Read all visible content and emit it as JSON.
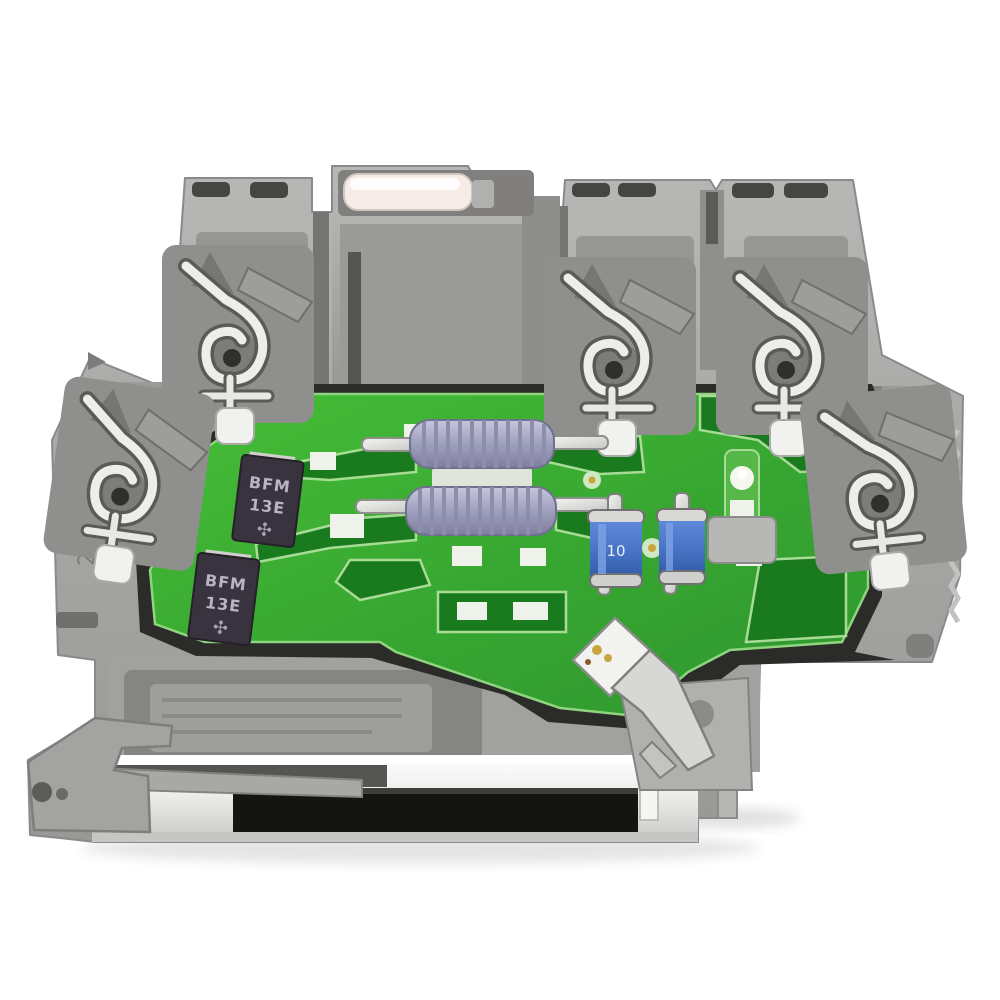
{
  "scene": {
    "type": "product-photograph",
    "subject": "Grey DIN-rail terminal block surge-protection module, cutaway housing showing green PCB with components, mounted on a DIN rail",
    "background_color": "#ffffff"
  },
  "labels": {
    "diode_top": {
      "line1": "BFM",
      "line2": "13E",
      "logo": "✣"
    },
    "diode_bottom": {
      "line1": "BFM",
      "line2": "13E",
      "logo": "✣"
    },
    "housing_marking": "2",
    "trimmer_left_marking": "10"
  },
  "palette": {
    "housing_grey": "#a6a6a4",
    "housing_grey_light": "#bcbcba",
    "housing_grey_dark": "#8b8b89",
    "housing_shadow": "#5f5f5d",
    "recess_dark": "#3c3c3a",
    "pcb_green_bright": "#43b835",
    "pcb_green": "#2f9630",
    "pcb_trace_dark": "#1a7a1e",
    "pcb_pale_outline": "#a8dc96",
    "pcb_edge_dark": "#2b2b29",
    "silkscreen_white": "#eef2ea",
    "metal_bright": "#f2f2f0",
    "metal_mid": "#cfcfcd",
    "metal_dark": "#6f6f6d",
    "diode_body": "#39333f",
    "diode_text": "#b9b3c3",
    "resistor_lavender": "#aaabc6",
    "trimmer_blue": "#4a76c8",
    "rail_white": "#fbfbf9",
    "rail_slot_black": "#141412",
    "solder_gold": "#c9a53f"
  },
  "components": [
    "cage-clamp-spring x5",
    "smd-diode BFM 13E x2",
    "wirewound-resistor x2",
    "gas-discharge-tube blue x2",
    "white-led",
    "smd-block",
    "ground-foot-bracket",
    "din-rail",
    "marker-strip",
    "rail-release-latch"
  ]
}
